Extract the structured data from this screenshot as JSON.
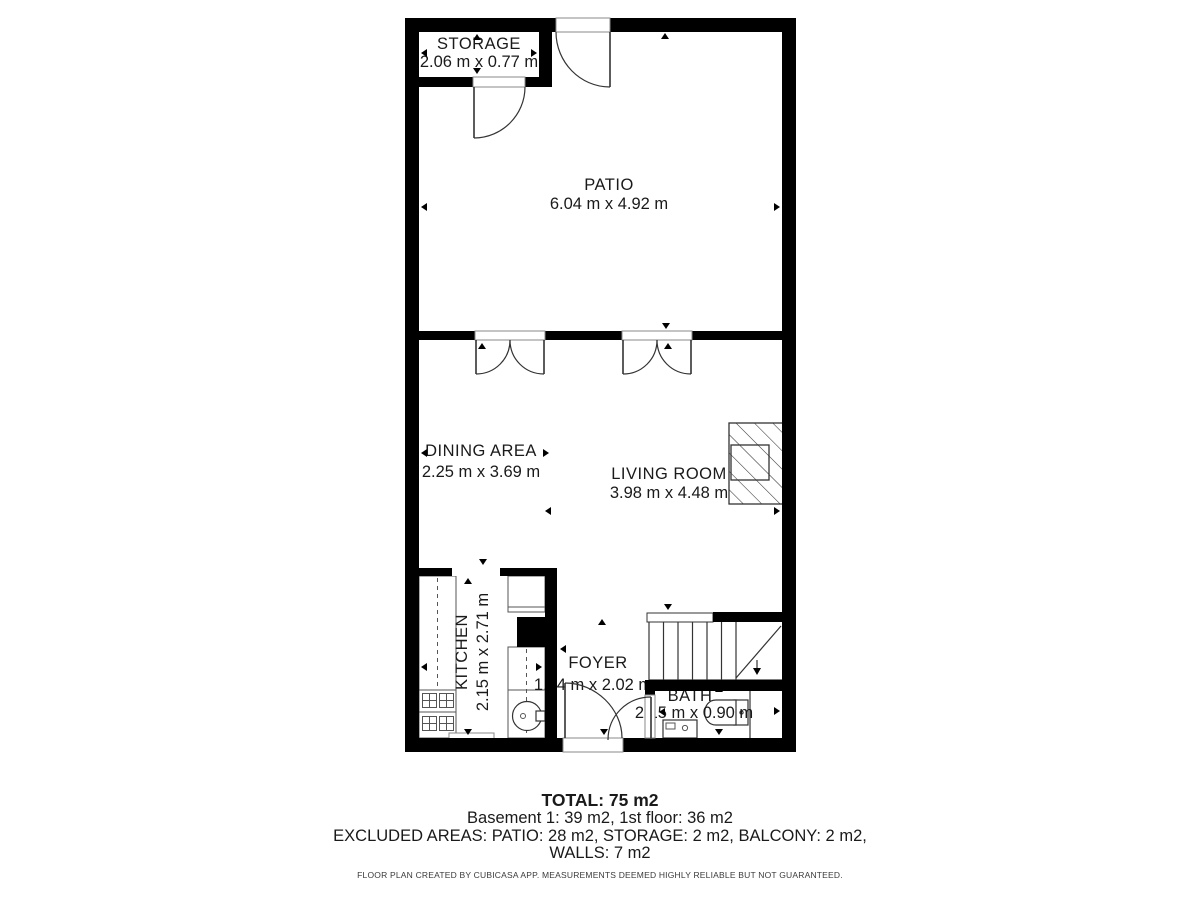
{
  "rooms": [
    {
      "name": "STORAGE",
      "dims": "2.06 m x 0.77 m"
    },
    {
      "name": "PATIO",
      "dims": "6.04 m x 4.92 m"
    },
    {
      "name": "DINING AREA",
      "dims": "2.25 m x 3.69 m"
    },
    {
      "name": "LIVING ROOM",
      "dims": "3.98 m x 4.48 m"
    },
    {
      "name": "KITCHEN",
      "dims": "2.15 m x 2.71 m"
    },
    {
      "name": "FOYER",
      "dims": "1.64 m x 2.02 m"
    },
    {
      "name": "BATH",
      "dims": "2.15 m x 0.90 m"
    }
  ],
  "summary": {
    "total": "TOTAL: 75 m2",
    "floors": "Basement 1: 39 m2, 1st floor: 36 m2",
    "excluded": "EXCLUDED AREAS: PATIO: 28 m2, STORAGE: 2 m2, BALCONY: 2 m2,",
    "walls": "WALLS: 7 m2",
    "disclaimer": "FLOOR PLAN CREATED BY CUBICASA APP. MEASUREMENTS DEEMED HIGHLY RELIABLE BUT NOT GUARANTEED."
  },
  "colors": {
    "wall": "#000000",
    "line": "#333333",
    "text": "#1a1a1a",
    "background": "#ffffff"
  }
}
